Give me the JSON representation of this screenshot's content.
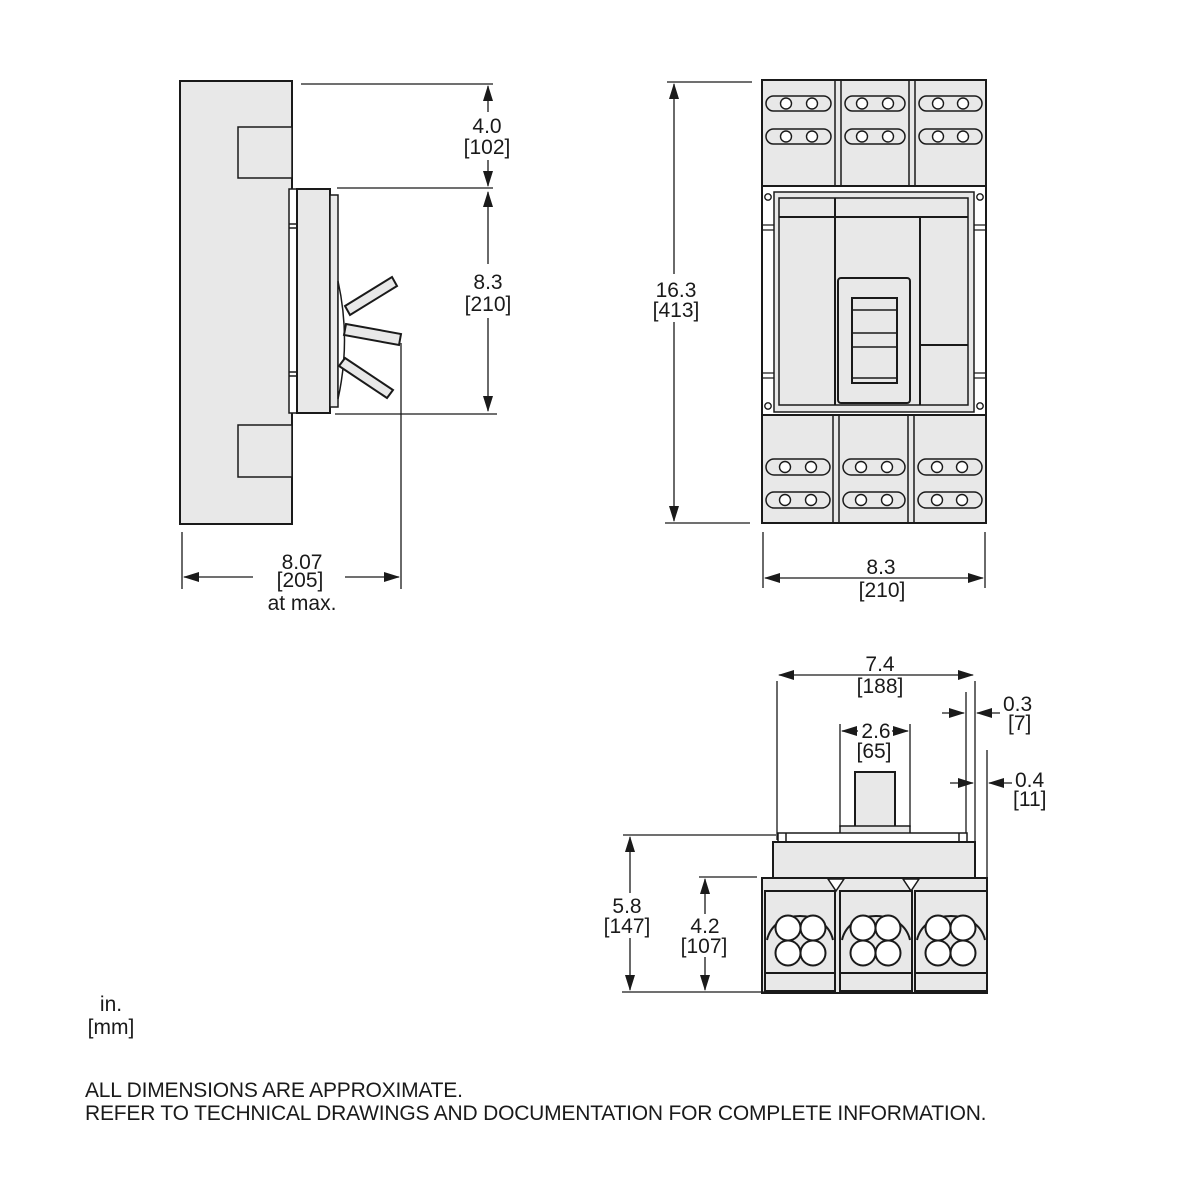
{
  "units_legend": {
    "inches": "in.",
    "millimeters": "[mm]"
  },
  "footer": {
    "line1": "ALL DIMENSIONS ARE APPROXIMATE.",
    "line2": "REFER TO TECHNICAL DRAWINGS AND DOCUMENTATION FOR COMPLETE INFORMATION."
  },
  "side_view": {
    "top_offset_in": "4.0",
    "top_offset_mm": "[102]",
    "body_height_in": "8.3",
    "body_height_mm": "[210]",
    "depth_in": "8.07",
    "depth_mm": "[205]",
    "depth_note": "at max."
  },
  "front_view": {
    "height_in": "16.3",
    "height_mm": "[413]",
    "width_in": "8.3",
    "width_mm": "[210]"
  },
  "bottom_view": {
    "width_in": "7.4",
    "width_mm": "[188]",
    "handle_width_in": "2.6",
    "handle_width_mm": "[65]",
    "lip_offset_in": "0.3",
    "lip_offset_mm": "[7]",
    "step_offset_in": "0.4",
    "step_offset_mm": "[11]",
    "height_in": "5.8",
    "height_mm": "[147]",
    "terminal_height_in": "4.2",
    "terminal_height_mm": "[107]"
  },
  "colors": {
    "body_fill": "#e8e8e8",
    "line": "#1a1a1a",
    "hole_fill": "#ffffff",
    "background": "#ffffff"
  }
}
